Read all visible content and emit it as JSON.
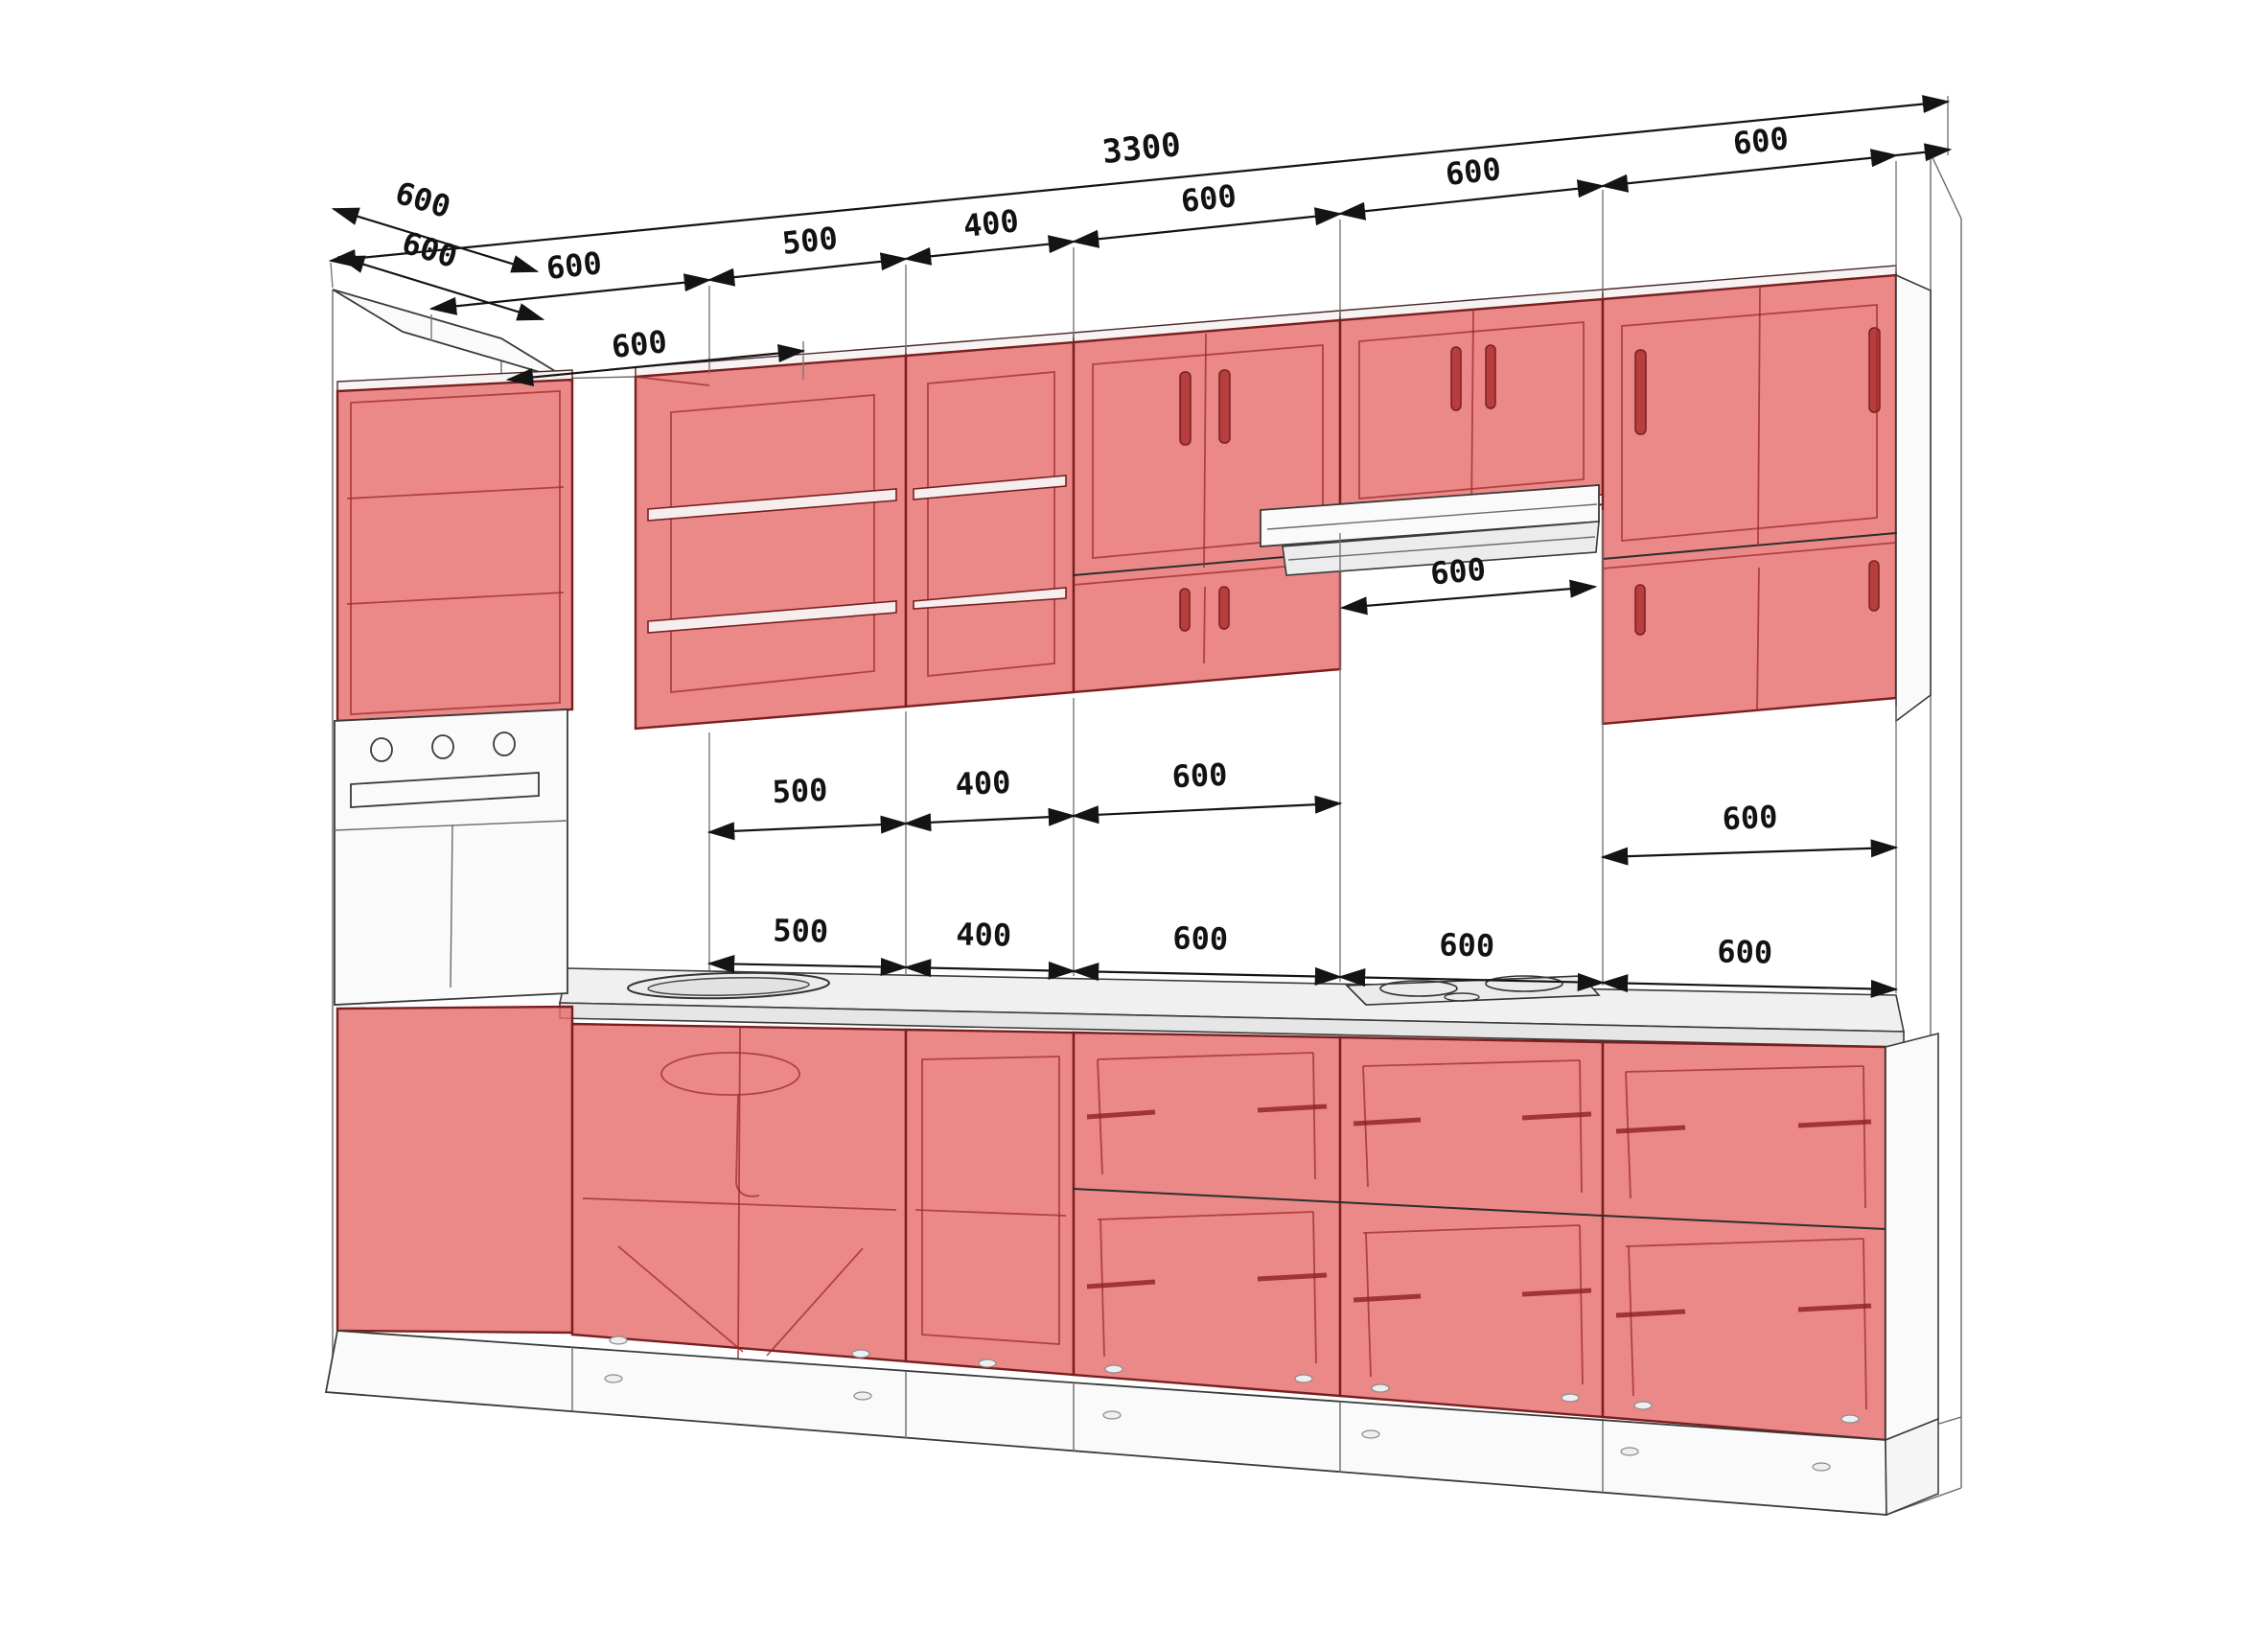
{
  "drawing": {
    "type": "kitchen-cabinet-dimension-diagram",
    "units": "mm"
  },
  "colors": {
    "cabinet_red": "#e66f6e",
    "edge_red": "#7a1f1f",
    "outline": "#2e2e2e",
    "dim_text": "#121212",
    "background": "#ffffff"
  },
  "dims": {
    "overall_width": "3300",
    "depth_left": [
      "600",
      "600"
    ],
    "top_chain": [
      "600",
      "500",
      "400",
      "600",
      "600",
      "600"
    ],
    "tall_cabinet_top": "600",
    "hood_width": "600",
    "mid_chain": [
      "500",
      "400",
      "600"
    ],
    "mid_right": "600",
    "bottom_chain": [
      "500",
      "400",
      "600",
      "600",
      "600"
    ]
  }
}
